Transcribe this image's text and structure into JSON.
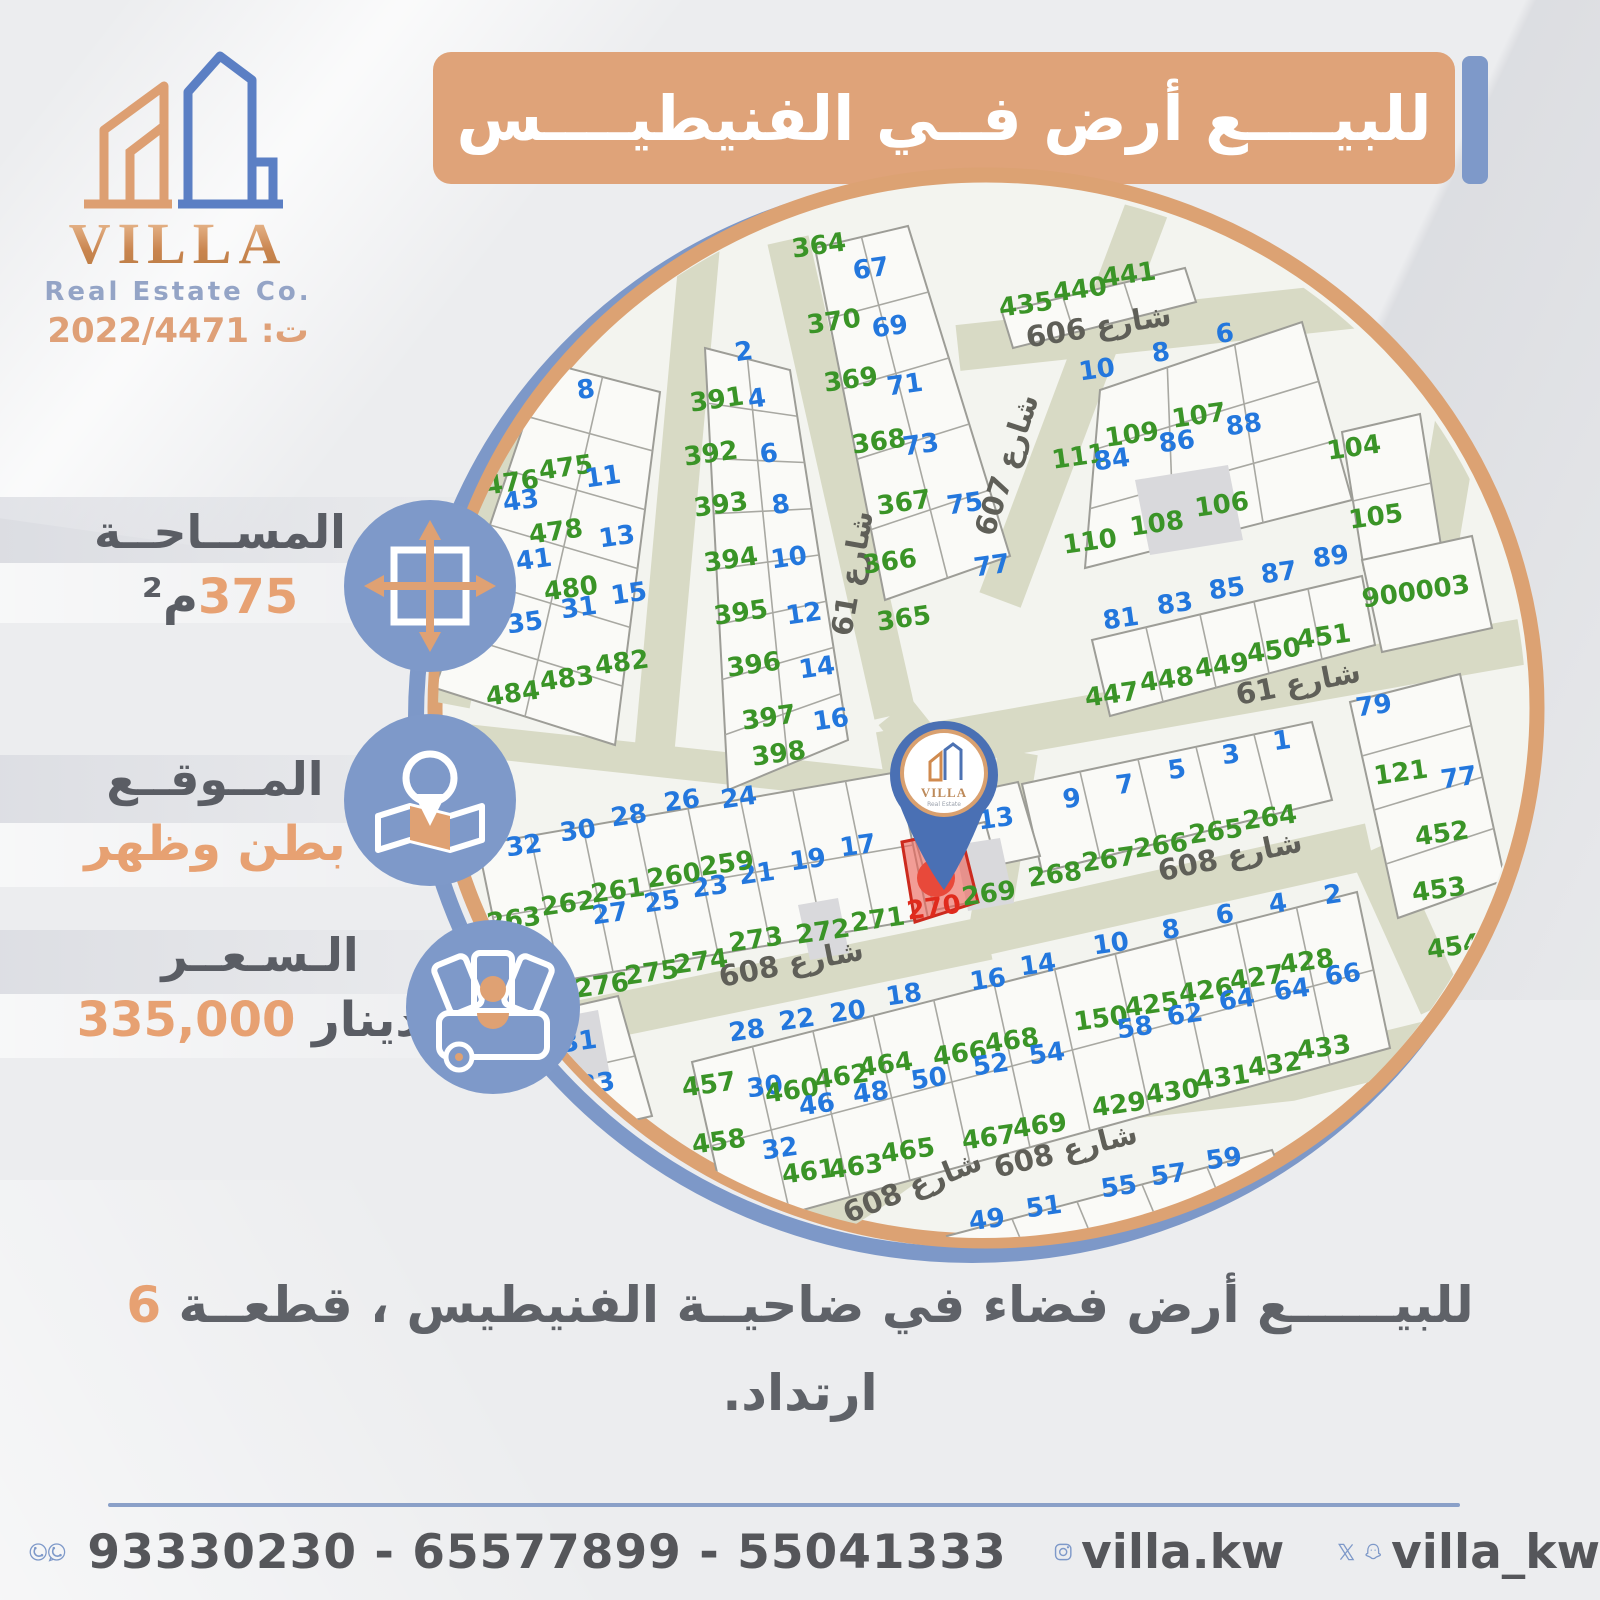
{
  "brand": {
    "name": "VILLA",
    "subtitle": "Real Estate Co.",
    "license": "ت: 2022/4471",
    "pin_subtitle": "Real Estate"
  },
  "banner": {
    "title": "للبيــــع أرض فــي الفنيطيــــس"
  },
  "info": {
    "area": {
      "label": "المســاحــة",
      "value": "375",
      "unit": "م²"
    },
    "location": {
      "label": "المــوقــع",
      "value": "بطن وظهر"
    },
    "price": {
      "label": "الـسـعــر",
      "value": "335,000",
      "unit": "دينار"
    }
  },
  "description": {
    "text": "للبيــــــع أرض فضاء في ضاحيــة الفنيطيس ، قطعــة",
    "highlight": "6",
    "line2": "ارتداد."
  },
  "footer": {
    "phones": "93330230 - 65577899 - 55041333",
    "instagram": "villa.kw",
    "social": "villa_kw"
  },
  "map": {
    "highlight_plot": "270",
    "colors": {
      "green": "#3a9427",
      "blue": "#2377dd",
      "red": "#e02b1d",
      "street_text": "#5f5f58",
      "street_fill": "#d8dac5",
      "ring_orange": "#dca273",
      "ring_blue": "#7d98c8"
    },
    "street_labels": [
      {
        "t": "شارع 606",
        "x": 1100,
        "y": 336,
        "r": -9
      },
      {
        "t": "شارع 607",
        "x": 1016,
        "y": 468,
        "r": -72
      },
      {
        "t": "شارع 61",
        "x": 862,
        "y": 575,
        "r": -80
      },
      {
        "t": "شارع 61",
        "x": 1300,
        "y": 693,
        "r": -11
      },
      {
        "t": "شارع 608",
        "x": 1232,
        "y": 866,
        "r": -12
      },
      {
        "t": "شارع 608",
        "x": 793,
        "y": 973,
        "r": -11
      },
      {
        "t": "شارع 608",
        "x": 916,
        "y": 1196,
        "r": -22
      },
      {
        "t": "شارع 608",
        "x": 1068,
        "y": 1160,
        "r": -14
      }
    ],
    "plots": [
      {
        "t": "8",
        "x": 587,
        "y": 398,
        "c": "b"
      },
      {
        "t": "476",
        "x": 513,
        "y": 491,
        "c": "g"
      },
      {
        "t": "43",
        "x": 522,
        "y": 509,
        "c": "b"
      },
      {
        "t": "475",
        "x": 567,
        "y": 476,
        "c": "g"
      },
      {
        "t": "11",
        "x": 604,
        "y": 485,
        "c": "b"
      },
      {
        "t": "478",
        "x": 557,
        "y": 540,
        "c": "g"
      },
      {
        "t": "13",
        "x": 618,
        "y": 545,
        "c": "b"
      },
      {
        "t": "41",
        "x": 535,
        "y": 568,
        "c": "b"
      },
      {
        "t": "480",
        "x": 572,
        "y": 597,
        "c": "g"
      },
      {
        "t": "15",
        "x": 630,
        "y": 602,
        "c": "b"
      },
      {
        "t": "31",
        "x": 580,
        "y": 616,
        "c": "b"
      },
      {
        "t": "35",
        "x": 526,
        "y": 631,
        "c": "b"
      },
      {
        "t": "482",
        "x": 623,
        "y": 671,
        "c": "g"
      },
      {
        "t": "483",
        "x": 568,
        "y": 687,
        "c": "g"
      },
      {
        "t": "484",
        "x": 514,
        "y": 702,
        "c": "g"
      },
      {
        "t": "8",
        "x": 430,
        "y": 688,
        "c": "b"
      },
      {
        "t": "2",
        "x": 745,
        "y": 360,
        "c": "b"
      },
      {
        "t": "391",
        "x": 718,
        "y": 408,
        "c": "g"
      },
      {
        "t": "4",
        "x": 758,
        "y": 407,
        "c": "b"
      },
      {
        "t": "392",
        "x": 712,
        "y": 462,
        "c": "g"
      },
      {
        "t": "6",
        "x": 770,
        "y": 462,
        "c": "b"
      },
      {
        "t": "393",
        "x": 722,
        "y": 513,
        "c": "g"
      },
      {
        "t": "8",
        "x": 782,
        "y": 513,
        "c": "b"
      },
      {
        "t": "394",
        "x": 732,
        "y": 568,
        "c": "g"
      },
      {
        "t": "10",
        "x": 790,
        "y": 566,
        "c": "b"
      },
      {
        "t": "395",
        "x": 742,
        "y": 621,
        "c": "g"
      },
      {
        "t": "12",
        "x": 805,
        "y": 622,
        "c": "b"
      },
      {
        "t": "396",
        "x": 755,
        "y": 673,
        "c": "g"
      },
      {
        "t": "14",
        "x": 818,
        "y": 676,
        "c": "b"
      },
      {
        "t": "397",
        "x": 770,
        "y": 726,
        "c": "g"
      },
      {
        "t": "16",
        "x": 832,
        "y": 728,
        "c": "b"
      },
      {
        "t": "398",
        "x": 780,
        "y": 762,
        "c": "g"
      },
      {
        "t": "364",
        "x": 820,
        "y": 254,
        "c": "g"
      },
      {
        "t": "67",
        "x": 872,
        "y": 277,
        "c": "b"
      },
      {
        "t": "370",
        "x": 835,
        "y": 330,
        "c": "g"
      },
      {
        "t": "69",
        "x": 891,
        "y": 335,
        "c": "b"
      },
      {
        "t": "369",
        "x": 852,
        "y": 388,
        "c": "g"
      },
      {
        "t": "71",
        "x": 906,
        "y": 393,
        "c": "b"
      },
      {
        "t": "368",
        "x": 880,
        "y": 450,
        "c": "g"
      },
      {
        "t": "73",
        "x": 922,
        "y": 453,
        "c": "b"
      },
      {
        "t": "367",
        "x": 905,
        "y": 511,
        "c": "g"
      },
      {
        "t": "75",
        "x": 966,
        "y": 512,
        "c": "b"
      },
      {
        "t": "366",
        "x": 891,
        "y": 570,
        "c": "g"
      },
      {
        "t": "365",
        "x": 905,
        "y": 627,
        "c": "g"
      },
      {
        "t": "435",
        "x": 1027,
        "y": 313,
        "c": "g"
      },
      {
        "t": "440",
        "x": 1081,
        "y": 298,
        "c": "g"
      },
      {
        "t": "441",
        "x": 1130,
        "y": 283,
        "c": "g"
      },
      {
        "t": "6",
        "x": 1226,
        "y": 342,
        "c": "b"
      },
      {
        "t": "8",
        "x": 1162,
        "y": 361,
        "c": "b"
      },
      {
        "t": "10",
        "x": 1098,
        "y": 378,
        "c": "b"
      },
      {
        "t": "107",
        "x": 1200,
        "y": 424,
        "c": "g"
      },
      {
        "t": "88",
        "x": 1245,
        "y": 433,
        "c": "b"
      },
      {
        "t": "109",
        "x": 1133,
        "y": 443,
        "c": "g"
      },
      {
        "t": "86",
        "x": 1178,
        "y": 450,
        "c": "b"
      },
      {
        "t": "111",
        "x": 1080,
        "y": 465,
        "c": "g"
      },
      {
        "t": "84",
        "x": 1113,
        "y": 468,
        "c": "b"
      },
      {
        "t": "104",
        "x": 1355,
        "y": 456,
        "c": "g"
      },
      {
        "t": "106",
        "x": 1223,
        "y": 513,
        "c": "g"
      },
      {
        "t": "108",
        "x": 1158,
        "y": 532,
        "c": "g"
      },
      {
        "t": "110",
        "x": 1091,
        "y": 550,
        "c": "g"
      },
      {
        "t": "105",
        "x": 1377,
        "y": 525,
        "c": "g"
      },
      {
        "t": "89",
        "x": 1332,
        "y": 565,
        "c": "b"
      },
      {
        "t": "87",
        "x": 1280,
        "y": 581,
        "c": "b"
      },
      {
        "t": "85",
        "x": 1228,
        "y": 597,
        "c": "b"
      },
      {
        "t": "83",
        "x": 1176,
        "y": 612,
        "c": "b"
      },
      {
        "t": "81",
        "x": 1122,
        "y": 627,
        "c": "b"
      },
      {
        "t": "451",
        "x": 1325,
        "y": 645,
        "c": "g"
      },
      {
        "t": "450",
        "x": 1275,
        "y": 659,
        "c": "g"
      },
      {
        "t": "449",
        "x": 1223,
        "y": 674,
        "c": "g"
      },
      {
        "t": "448",
        "x": 1168,
        "y": 688,
        "c": "g"
      },
      {
        "t": "447",
        "x": 1113,
        "y": 703,
        "c": "g"
      },
      {
        "t": "77",
        "x": 993,
        "y": 574,
        "c": "b"
      },
      {
        "t": "900003",
        "x": 1417,
        "y": 600,
        "c": "g"
      },
      {
        "t": "1",
        "x": 1283,
        "y": 749,
        "c": "b"
      },
      {
        "t": "3",
        "x": 1232,
        "y": 763,
        "c": "b"
      },
      {
        "t": "5",
        "x": 1178,
        "y": 778,
        "c": "b"
      },
      {
        "t": "7",
        "x": 1126,
        "y": 793,
        "c": "b"
      },
      {
        "t": "9",
        "x": 1073,
        "y": 807,
        "c": "b"
      },
      {
        "t": "13",
        "x": 997,
        "y": 827,
        "c": "b"
      },
      {
        "t": "264",
        "x": 1271,
        "y": 826,
        "c": "g"
      },
      {
        "t": "265",
        "x": 1217,
        "y": 840,
        "c": "g"
      },
      {
        "t": "266",
        "x": 1162,
        "y": 854,
        "c": "g"
      },
      {
        "t": "267",
        "x": 1110,
        "y": 868,
        "c": "g"
      },
      {
        "t": "268",
        "x": 1056,
        "y": 883,
        "c": "g"
      },
      {
        "t": "269",
        "x": 990,
        "y": 902,
        "c": "g"
      },
      {
        "t": "79",
        "x": 1375,
        "y": 714,
        "c": "b"
      },
      {
        "t": "121",
        "x": 1402,
        "y": 781,
        "c": "g"
      },
      {
        "t": "77",
        "x": 1460,
        "y": 786,
        "c": "b"
      },
      {
        "t": "452",
        "x": 1443,
        "y": 842,
        "c": "g"
      },
      {
        "t": "453",
        "x": 1440,
        "y": 898,
        "c": "g"
      },
      {
        "t": "454",
        "x": 1455,
        "y": 955,
        "c": "g"
      },
      {
        "t": "24",
        "x": 740,
        "y": 806,
        "c": "b"
      },
      {
        "t": "26",
        "x": 683,
        "y": 809,
        "c": "b"
      },
      {
        "t": "28",
        "x": 630,
        "y": 824,
        "c": "b"
      },
      {
        "t": "30",
        "x": 579,
        "y": 839,
        "c": "b"
      },
      {
        "t": "32",
        "x": 525,
        "y": 854,
        "c": "b"
      },
      {
        "t": "17",
        "x": 859,
        "y": 854,
        "c": "b"
      },
      {
        "t": "19",
        "x": 809,
        "y": 868,
        "c": "b"
      },
      {
        "t": "21",
        "x": 758,
        "y": 882,
        "c": "b"
      },
      {
        "t": "23",
        "x": 711,
        "y": 895,
        "c": "b"
      },
      {
        "t": "25",
        "x": 663,
        "y": 910,
        "c": "b"
      },
      {
        "t": "27",
        "x": 611,
        "y": 922,
        "c": "b"
      },
      {
        "t": "259",
        "x": 728,
        "y": 872,
        "c": "g"
      },
      {
        "t": "260",
        "x": 675,
        "y": 884,
        "c": "g"
      },
      {
        "t": "261",
        "x": 619,
        "y": 899,
        "c": "g"
      },
      {
        "t": "262",
        "x": 569,
        "y": 912,
        "c": "g"
      },
      {
        "t": "263",
        "x": 515,
        "y": 928,
        "c": "g"
      },
      {
        "t": "270",
        "x": 935,
        "y": 916,
        "c": "r"
      },
      {
        "t": "271",
        "x": 879,
        "y": 928,
        "c": "g"
      },
      {
        "t": "272",
        "x": 824,
        "y": 940,
        "c": "g"
      },
      {
        "t": "273",
        "x": 757,
        "y": 948,
        "c": "g"
      },
      {
        "t": "274",
        "x": 702,
        "y": 970,
        "c": "g"
      },
      {
        "t": "275",
        "x": 653,
        "y": 981,
        "c": "g"
      },
      {
        "t": "276",
        "x": 603,
        "y": 994,
        "c": "g"
      },
      {
        "t": "31",
        "x": 580,
        "y": 1050,
        "c": "b"
      },
      {
        "t": "33",
        "x": 598,
        "y": 1092,
        "c": "b"
      },
      {
        "t": "28",
        "x": 748,
        "y": 1039,
        "c": "b"
      },
      {
        "t": "22",
        "x": 798,
        "y": 1028,
        "c": "b"
      },
      {
        "t": "20",
        "x": 849,
        "y": 1020,
        "c": "b"
      },
      {
        "t": "18",
        "x": 905,
        "y": 1003,
        "c": "b"
      },
      {
        "t": "16",
        "x": 989,
        "y": 988,
        "c": "b"
      },
      {
        "t": "14",
        "x": 1039,
        "y": 973,
        "c": "b"
      },
      {
        "t": "10",
        "x": 1112,
        "y": 952,
        "c": "b"
      },
      {
        "t": "8",
        "x": 1172,
        "y": 938,
        "c": "b"
      },
      {
        "t": "6",
        "x": 1226,
        "y": 923,
        "c": "b"
      },
      {
        "t": "4",
        "x": 1279,
        "y": 912,
        "c": "b"
      },
      {
        "t": "2",
        "x": 1334,
        "y": 903,
        "c": "b"
      },
      {
        "t": "457",
        "x": 710,
        "y": 1093,
        "c": "g"
      },
      {
        "t": "30",
        "x": 766,
        "y": 1095,
        "c": "b"
      },
      {
        "t": "460",
        "x": 793,
        "y": 1099,
        "c": "g"
      },
      {
        "t": "46",
        "x": 818,
        "y": 1113,
        "c": "b"
      },
      {
        "t": "462",
        "x": 843,
        "y": 1085,
        "c": "g"
      },
      {
        "t": "48",
        "x": 872,
        "y": 1101,
        "c": "b"
      },
      {
        "t": "464",
        "x": 887,
        "y": 1073,
        "c": "g"
      },
      {
        "t": "50",
        "x": 930,
        "y": 1087,
        "c": "b"
      },
      {
        "t": "466",
        "x": 961,
        "y": 1062,
        "c": "g"
      },
      {
        "t": "52",
        "x": 992,
        "y": 1073,
        "c": "b"
      },
      {
        "t": "468",
        "x": 1013,
        "y": 1049,
        "c": "g"
      },
      {
        "t": "54",
        "x": 1048,
        "y": 1062,
        "c": "b"
      },
      {
        "t": "458",
        "x": 720,
        "y": 1150,
        "c": "g"
      },
      {
        "t": "32",
        "x": 781,
        "y": 1157,
        "c": "b"
      },
      {
        "t": "461",
        "x": 810,
        "y": 1180,
        "c": "g"
      },
      {
        "t": "463",
        "x": 857,
        "y": 1175,
        "c": "g"
      },
      {
        "t": "465",
        "x": 909,
        "y": 1159,
        "c": "g"
      },
      {
        "t": "467",
        "x": 990,
        "y": 1146,
        "c": "g"
      },
      {
        "t": "469",
        "x": 1041,
        "y": 1134,
        "c": "g"
      },
      {
        "t": "429",
        "x": 1120,
        "y": 1113,
        "c": "g"
      },
      {
        "t": "430",
        "x": 1174,
        "y": 1100,
        "c": "g"
      },
      {
        "t": "431",
        "x": 1224,
        "y": 1086,
        "c": "g"
      },
      {
        "t": "432",
        "x": 1276,
        "y": 1073,
        "c": "g"
      },
      {
        "t": "433",
        "x": 1325,
        "y": 1056,
        "c": "g"
      },
      {
        "t": "425",
        "x": 1153,
        "y": 1013,
        "c": "g"
      },
      {
        "t": "426",
        "x": 1207,
        "y": 999,
        "c": "g"
      },
      {
        "t": "427",
        "x": 1258,
        "y": 986,
        "c": "g"
      },
      {
        "t": "428",
        "x": 1308,
        "y": 970,
        "c": "g"
      },
      {
        "t": "150",
        "x": 1102,
        "y": 1027,
        "c": "g"
      },
      {
        "t": "58",
        "x": 1136,
        "y": 1036,
        "c": "b"
      },
      {
        "t": "62",
        "x": 1186,
        "y": 1023,
        "c": "b"
      },
      {
        "t": "64",
        "x": 1238,
        "y": 1008,
        "c": "b"
      },
      {
        "t": "64",
        "x": 1293,
        "y": 998,
        "c": "b"
      },
      {
        "t": "66",
        "x": 1344,
        "y": 983,
        "c": "b"
      },
      {
        "t": "49",
        "x": 988,
        "y": 1228,
        "c": "b"
      },
      {
        "t": "51",
        "x": 1045,
        "y": 1215,
        "c": "b"
      },
      {
        "t": "55",
        "x": 1120,
        "y": 1195,
        "c": "b"
      },
      {
        "t": "57",
        "x": 1170,
        "y": 1183,
        "c": "b"
      },
      {
        "t": "59",
        "x": 1225,
        "y": 1167,
        "c": "b"
      }
    ]
  }
}
